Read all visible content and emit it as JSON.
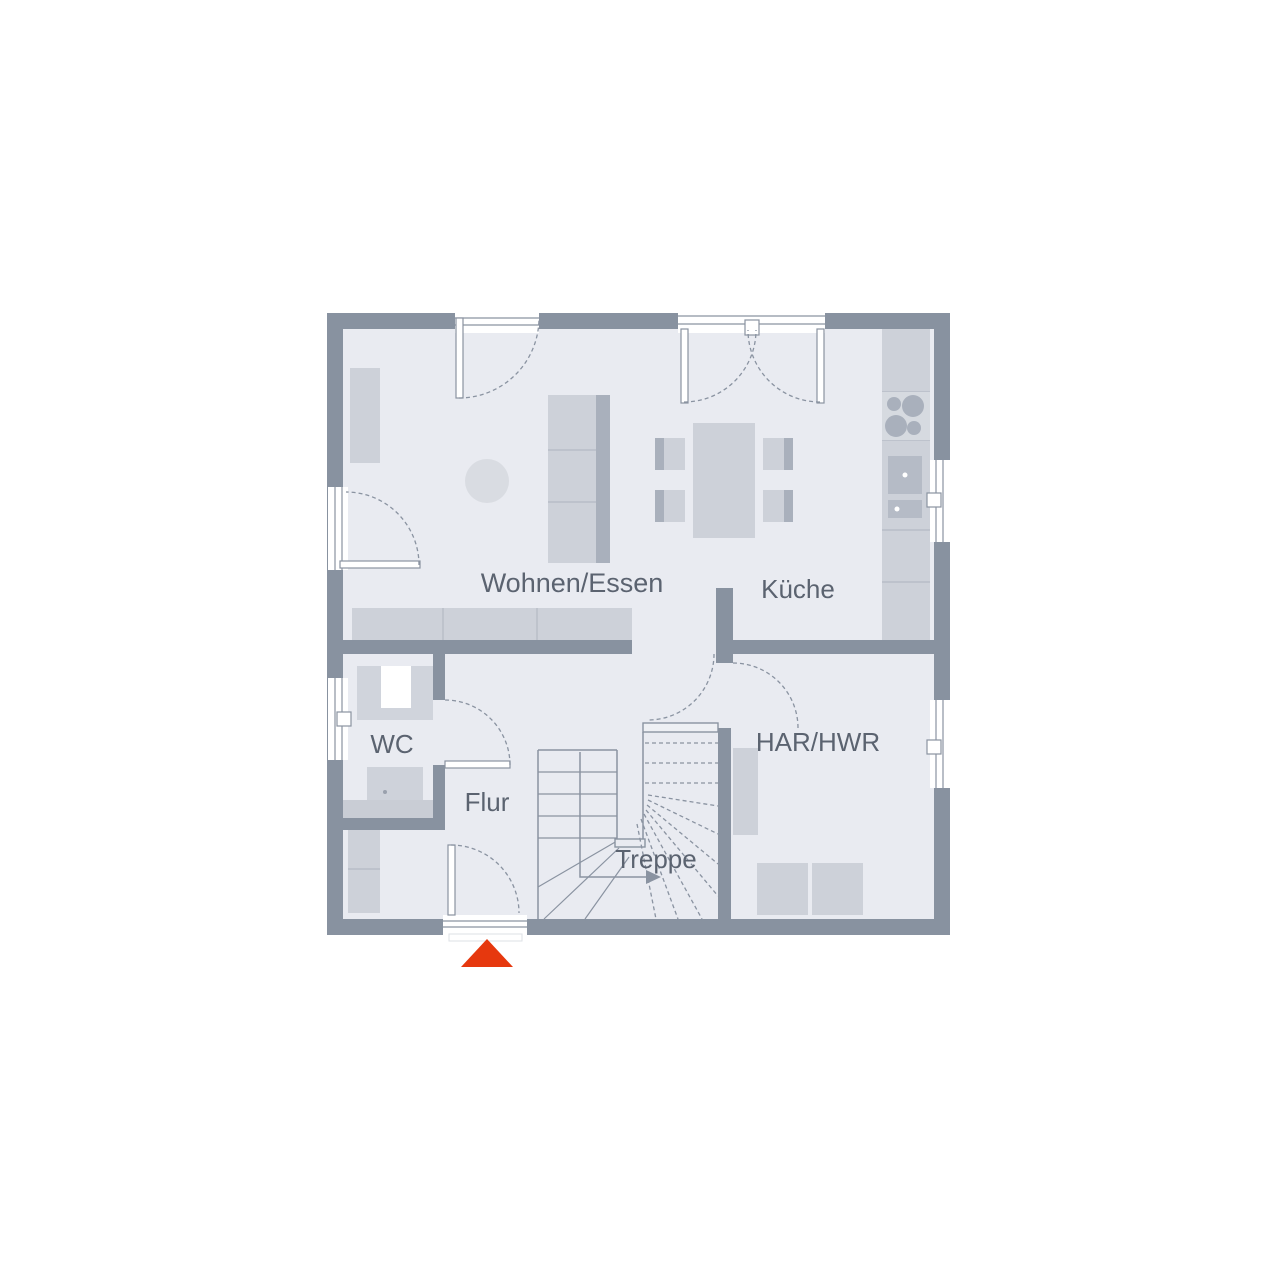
{
  "plan": {
    "type": "floor-plan",
    "rooms": [
      {
        "id": "wohnen-essen",
        "label": "Wohnen/Essen"
      },
      {
        "id": "kueche",
        "label": "Küche"
      },
      {
        "id": "wc",
        "label": "WC"
      },
      {
        "id": "flur",
        "label": "Flur"
      },
      {
        "id": "treppe",
        "label": "Treppe"
      },
      {
        "id": "har-hwr",
        "label": "HAR/HWR"
      }
    ],
    "entrance_marker": {
      "shape": "triangle-up",
      "color": "#e6380e"
    },
    "furniture": [
      "sofa",
      "round-rug",
      "shelf",
      "sideboard",
      "dining-table",
      "four-chairs",
      "kitchen-counter",
      "stove-4-burners",
      "kitchen-sink",
      "toilet",
      "wc-sink",
      "wardrobe",
      "utility-shelf",
      "washer",
      "dryer",
      "u-shaped-stair"
    ],
    "colors": {
      "wall": "#8892a0",
      "floor": "#e9ebf1",
      "furniture": "#cdd1d9",
      "furniture_dark": "#a9b0bc",
      "fixture": "#b5bbc6",
      "line": "#8a93a1",
      "label_text": "#5b6370",
      "accent_red": "#e6380e",
      "background": "#ffffff"
    }
  }
}
